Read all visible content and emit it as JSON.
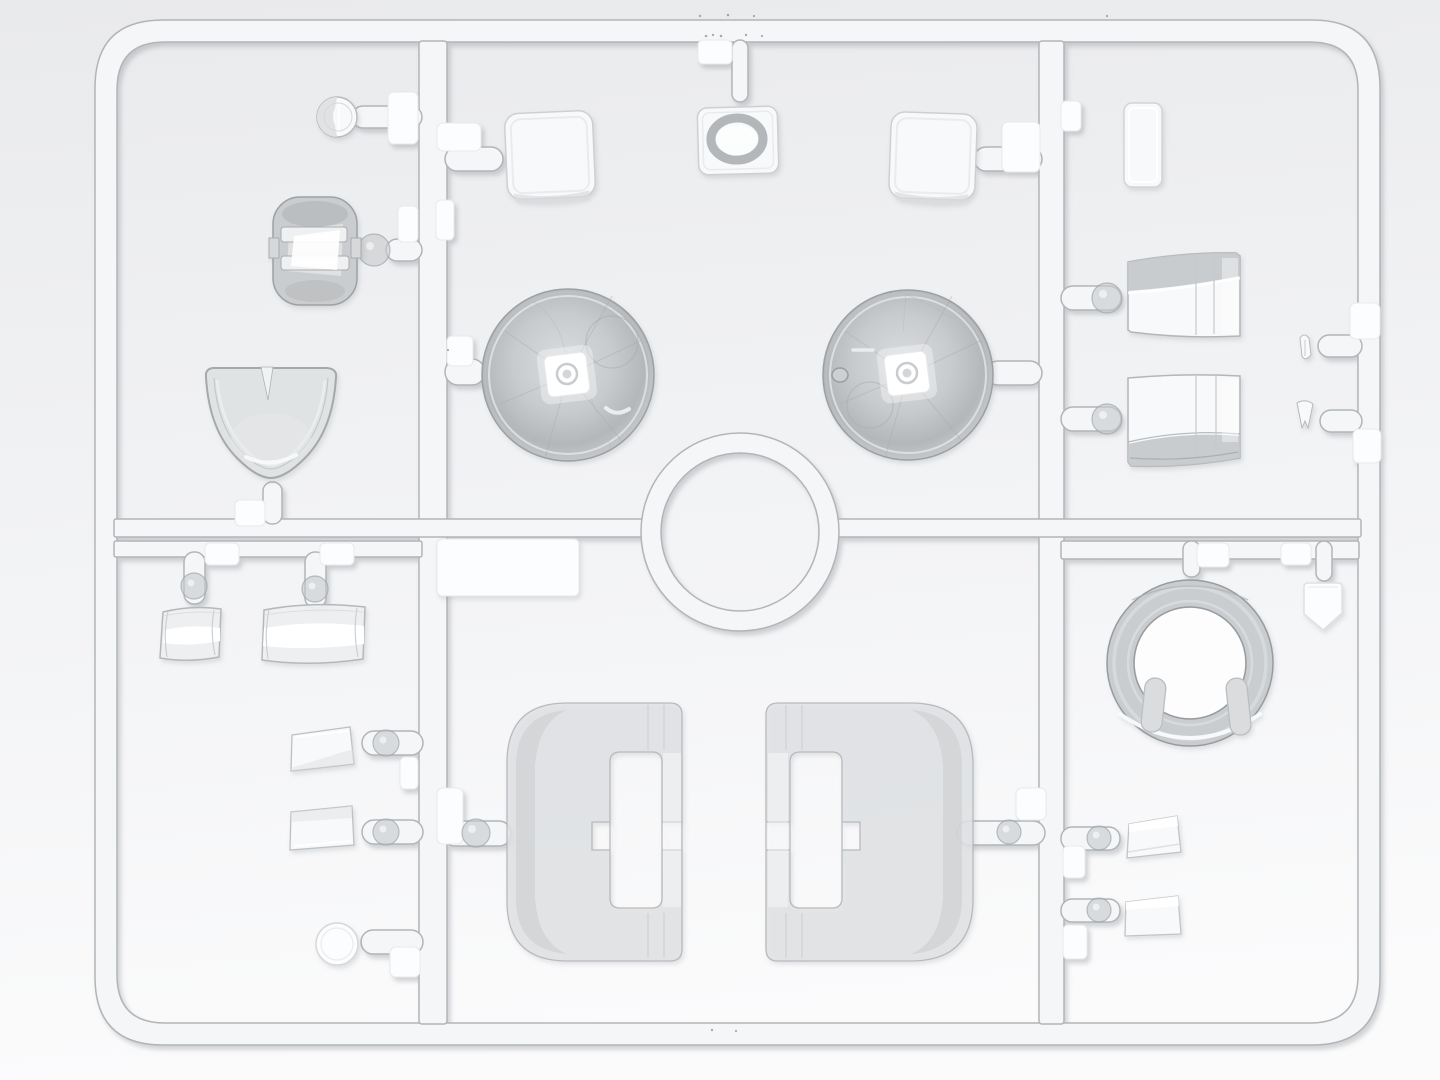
{
  "meta": {
    "image_type": "3D render of an injection-moulded clear (transparent) parts sprue from a plastic model kit",
    "orientation": "top-down view, soft studio light, shadow cast to lower-right",
    "text_content": "none (image contains no text)"
  },
  "palette": {
    "bg_top": "#e9eaec",
    "bg_mid": "#f1f2f4",
    "bg_bottom": "#fbfbfc",
    "runner_fill": "#f5f6f8",
    "runner_edge": "#b2b5b8",
    "tab_fill": "#fcfdfe",
    "tab_edge": "#e7e9eb",
    "ball_fill": "#c7cacd",
    "ball_edge": "#9da0a3",
    "part_white": "#f8f9fa",
    "part_light": "#dfe2e4",
    "part_gray": "#c8cbce",
    "part_edge": "#b7babd",
    "dome_light": "#dadcde",
    "dome_mid": "#c8cbce",
    "dome_deep": "#b4b7ba",
    "dome_rim": "#c6c9cc",
    "dome_edge": "#9da0a3",
    "band_gray": "#c3c6c9",
    "hole_white": "#fdfdfe",
    "speck": "#5d6266"
  },
  "sprue": {
    "frame_bbox": [
      95,
      20,
      1285,
      1025
    ],
    "sections": 6,
    "center_ring_runner": {
      "center": [
        740,
        532
      ],
      "outer_r": 99,
      "inner_r": 79
    },
    "gate_balls": 11,
    "ejector_tabs": 21,
    "parts": [
      {
        "name": "small-round-lens",
        "bbox": [
          317,
          97,
          40,
          40
        ]
      },
      {
        "name": "periscope-lens-block",
        "bbox": [
          273,
          197,
          84,
          108
        ]
      },
      {
        "name": "windscreen-bowl",
        "bbox": [
          202,
          363,
          138,
          119
        ]
      },
      {
        "name": "hatch-square-left",
        "bbox": [
          506,
          112,
          88,
          86
        ]
      },
      {
        "name": "ring-insert-square",
        "bbox": [
          698,
          107,
          80,
          67
        ]
      },
      {
        "name": "hatch-square-right",
        "bbox": [
          890,
          113,
          86,
          86
        ]
      },
      {
        "name": "small-rect-window",
        "bbox": [
          1124,
          103,
          38,
          84
        ]
      },
      {
        "name": "dome-lens-left",
        "center": [
          568,
          375
        ],
        "radius": 86
      },
      {
        "name": "dome-lens-right",
        "center": [
          908,
          375
        ],
        "radius": 85
      },
      {
        "name": "flat-plate",
        "bbox": [
          437,
          539,
          142,
          57
        ]
      },
      {
        "name": "vision-block-upper",
        "bbox": [
          1128,
          253,
          112,
          86
        ]
      },
      {
        "name": "vision-block-lower",
        "bbox": [
          1128,
          374,
          112,
          92
        ]
      },
      {
        "name": "tooth-part-1",
        "bbox": [
          1297,
          334,
          16,
          28
        ]
      },
      {
        "name": "tooth-part-2",
        "bbox": [
          1296,
          400,
          18,
          30
        ]
      },
      {
        "name": "curved-glass-small",
        "bbox": [
          160,
          608,
          62,
          50
        ]
      },
      {
        "name": "curved-glass-large",
        "bbox": [
          262,
          606,
          105,
          54
        ]
      },
      {
        "name": "wedge-lamp-1",
        "bbox": [
          290,
          727,
          64,
          45
        ]
      },
      {
        "name": "wedge-lamp-2",
        "bbox": [
          290,
          806,
          64,
          45
        ]
      },
      {
        "name": "round-lamp-lens",
        "center": [
          337,
          944
        ],
        "radius": 21
      },
      {
        "name": "canopy-shell-left",
        "bbox": [
          507,
          703,
          175,
          258
        ]
      },
      {
        "name": "canopy-shell-right",
        "bbox": [
          766,
          703,
          207,
          258
        ]
      },
      {
        "name": "turret-ring",
        "center": [
          1190,
          663
        ],
        "outer_r": 83,
        "inner_r": 56
      },
      {
        "name": "shield-window",
        "bbox": [
          1302,
          582,
          40,
          50
        ]
      },
      {
        "name": "wedge-lamp-right-1",
        "bbox": [
          1125,
          816,
          56,
          42
        ]
      },
      {
        "name": "wedge-lamp-right-2",
        "bbox": [
          1124,
          896,
          57,
          42
        ]
      }
    ]
  }
}
